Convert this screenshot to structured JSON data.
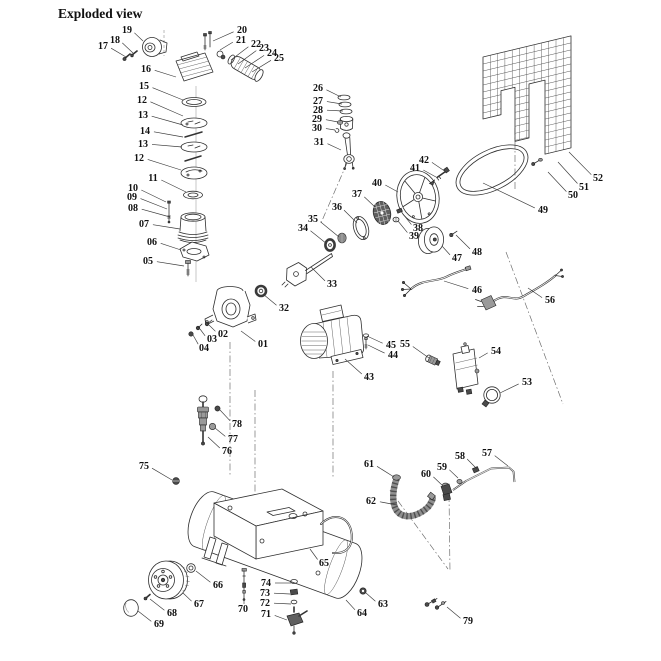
{
  "title": "Exploded view",
  "colors": {
    "ink": "#2f2f2f",
    "background": "#ffffff"
  },
  "diagram": {
    "type": "exploded-parts-diagram",
    "labels": [
      {
        "n": "01",
        "x": 263,
        "y": 344,
        "tx": 241,
        "ty": 331
      },
      {
        "n": "02",
        "x": 223,
        "y": 334,
        "tx": 209,
        "ty": 325
      },
      {
        "n": "03",
        "x": 212,
        "y": 339,
        "tx": 200,
        "ty": 329
      },
      {
        "n": "04",
        "x": 204,
        "y": 348,
        "tx": 193,
        "ty": 335
      },
      {
        "n": "05",
        "x": 148,
        "y": 261,
        "tx": 184,
        "ty": 266
      },
      {
        "n": "06",
        "x": 152,
        "y": 242,
        "tx": 181,
        "ty": 250
      },
      {
        "n": "07",
        "x": 144,
        "y": 224,
        "tx": 180,
        "ty": 229
      },
      {
        "n": "08",
        "x": 133,
        "y": 208,
        "tx": 170,
        "ty": 217
      },
      {
        "n": "09",
        "x": 132,
        "y": 197,
        "tx": 167,
        "ty": 209
      },
      {
        "n": "10",
        "x": 133,
        "y": 188,
        "tx": 166,
        "ty": 202
      },
      {
        "n": "11",
        "x": 153,
        "y": 178,
        "tx": 186,
        "ty": 192
      },
      {
        "n": "12",
        "x": 142,
        "y": 100,
        "tx": 183,
        "ty": 116
      },
      {
        "n": "13",
        "x": 143,
        "y": 115,
        "tx": 183,
        "ty": 125
      },
      {
        "n": "14",
        "x": 145,
        "y": 131,
        "tx": 183,
        "ty": 137
      },
      {
        "n": "13",
        "x": 143,
        "y": 144,
        "tx": 182,
        "ty": 147
      },
      {
        "n": "12",
        "x": 139,
        "y": 158,
        "tx": 181,
        "ty": 170
      },
      {
        "n": "15",
        "x": 144,
        "y": 86,
        "tx": 183,
        "ty": 100
      },
      {
        "n": "16",
        "x": 146,
        "y": 69,
        "tx": 176,
        "ty": 77
      },
      {
        "n": "17",
        "x": 103,
        "y": 46,
        "tx": 126,
        "ty": 57
      },
      {
        "n": "18",
        "x": 115,
        "y": 40,
        "tx": 133,
        "ty": 53
      },
      {
        "n": "19",
        "x": 127,
        "y": 30,
        "tx": 143,
        "ty": 41
      },
      {
        "n": "20",
        "x": 242,
        "y": 30,
        "tx": 213,
        "ty": 41
      },
      {
        "n": "21",
        "x": 241,
        "y": 40,
        "tx": 220,
        "ty": 50
      },
      {
        "n": "22",
        "x": 256,
        "y": 44,
        "tx": 231,
        "ty": 60
      },
      {
        "n": "23",
        "x": 264,
        "y": 48,
        "tx": 238,
        "ty": 64
      },
      {
        "n": "24",
        "x": 272,
        "y": 53,
        "tx": 245,
        "ty": 68
      },
      {
        "n": "25",
        "x": 279,
        "y": 58,
        "tx": 252,
        "ty": 72
      },
      {
        "n": "26",
        "x": 318,
        "y": 88,
        "tx": 341,
        "ty": 97
      },
      {
        "n": "27",
        "x": 318,
        "y": 101,
        "tx": 342,
        "ty": 104
      },
      {
        "n": "28",
        "x": 318,
        "y": 110,
        "tx": 343,
        "ty": 111
      },
      {
        "n": "29",
        "x": 317,
        "y": 119,
        "tx": 338,
        "ty": 122
      },
      {
        "n": "30",
        "x": 317,
        "y": 128,
        "tx": 335,
        "ty": 130
      },
      {
        "n": "31",
        "x": 319,
        "y": 142,
        "tx": 341,
        "ty": 150
      },
      {
        "n": "32",
        "x": 284,
        "y": 308,
        "tx": 263,
        "ty": 294
      },
      {
        "n": "33",
        "x": 332,
        "y": 284,
        "tx": 311,
        "ty": 267
      },
      {
        "n": "34",
        "x": 303,
        "y": 228,
        "tx": 327,
        "ty": 244
      },
      {
        "n": "35",
        "x": 313,
        "y": 219,
        "tx": 339,
        "ty": 237
      },
      {
        "n": "36",
        "x": 337,
        "y": 207,
        "tx": 357,
        "ty": 223
      },
      {
        "n": "37",
        "x": 357,
        "y": 194,
        "tx": 375,
        "ty": 207
      },
      {
        "n": "38",
        "x": 418,
        "y": 228,
        "tx": 403,
        "ty": 214
      },
      {
        "n": "39",
        "x": 414,
        "y": 236,
        "tx": 398,
        "ty": 221
      },
      {
        "n": "40",
        "x": 377,
        "y": 183,
        "tx": 398,
        "ty": 192
      },
      {
        "n": "41",
        "x": 415,
        "y": 168,
        "tx": 436,
        "ty": 177
      },
      {
        "n": "42",
        "x": 424,
        "y": 160,
        "tx": 446,
        "ty": 172
      },
      {
        "n": "43",
        "x": 369,
        "y": 377,
        "tx": 345,
        "ty": 359
      },
      {
        "n": "44",
        "x": 393,
        "y": 355,
        "tx": 368,
        "ty": 345
      },
      {
        "n": "45",
        "x": 391,
        "y": 345,
        "tx": 367,
        "ty": 336
      },
      {
        "n": "46",
        "x": 477,
        "y": 290,
        "tx": 444,
        "ty": 281
      },
      {
        "n": "47",
        "x": 457,
        "y": 258,
        "tx": 442,
        "ty": 246
      },
      {
        "n": "48",
        "x": 477,
        "y": 252,
        "tx": 456,
        "ty": 235
      },
      {
        "n": "49",
        "x": 543,
        "y": 210,
        "tx": 483,
        "ty": 183
      },
      {
        "n": "50",
        "x": 573,
        "y": 195,
        "tx": 548,
        "ty": 172
      },
      {
        "n": "51",
        "x": 584,
        "y": 187,
        "tx": 558,
        "ty": 162
      },
      {
        "n": "52",
        "x": 598,
        "y": 178,
        "tx": 569,
        "ty": 152
      },
      {
        "n": "53",
        "x": 527,
        "y": 382,
        "tx": 500,
        "ty": 393
      },
      {
        "n": "54",
        "x": 496,
        "y": 351,
        "tx": 479,
        "ty": 358
      },
      {
        "n": "55",
        "x": 405,
        "y": 344,
        "tx": 429,
        "ty": 358
      },
      {
        "n": "56",
        "x": 550,
        "y": 300,
        "tx": 528,
        "ty": 288
      },
      {
        "n": "57",
        "x": 487,
        "y": 453,
        "tx": 508,
        "ty": 466
      },
      {
        "n": "58",
        "x": 460,
        "y": 456,
        "tx": 477,
        "ty": 469
      },
      {
        "n": "59",
        "x": 442,
        "y": 467,
        "tx": 458,
        "ty": 478
      },
      {
        "n": "60",
        "x": 426,
        "y": 474,
        "tx": 443,
        "ty": 486
      },
      {
        "n": "61",
        "x": 369,
        "y": 464,
        "tx": 394,
        "ty": 477
      },
      {
        "n": "62",
        "x": 371,
        "y": 501,
        "tx": 397,
        "ty": 505
      },
      {
        "n": "63",
        "x": 383,
        "y": 604,
        "tx": 366,
        "ty": 593
      },
      {
        "n": "64",
        "x": 362,
        "y": 613,
        "tx": 346,
        "ty": 600
      },
      {
        "n": "65",
        "x": 324,
        "y": 563,
        "tx": 310,
        "ty": 549
      },
      {
        "n": "66",
        "x": 218,
        "y": 585,
        "tx": 196,
        "ty": 571
      },
      {
        "n": "67",
        "x": 199,
        "y": 604,
        "tx": 183,
        "ty": 593
      },
      {
        "n": "68",
        "x": 172,
        "y": 613,
        "tx": 150,
        "ty": 599
      },
      {
        "n": "69",
        "x": 159,
        "y": 624,
        "tx": 138,
        "ty": 611
      },
      {
        "n": "70",
        "x": 243,
        "y": 609,
        "tx": 244,
        "ty": 600
      },
      {
        "n": "71",
        "x": 266,
        "y": 614,
        "tx": 287,
        "ty": 620
      },
      {
        "n": "72",
        "x": 265,
        "y": 603,
        "tx": 291,
        "ty": 604
      },
      {
        "n": "73",
        "x": 265,
        "y": 593,
        "tx": 290,
        "ty": 594
      },
      {
        "n": "74",
        "x": 266,
        "y": 583,
        "tx": 291,
        "ty": 583
      },
      {
        "n": "75",
        "x": 144,
        "y": 466,
        "tx": 172,
        "ty": 480
      },
      {
        "n": "76",
        "x": 227,
        "y": 451,
        "tx": 208,
        "ty": 437
      },
      {
        "n": "77",
        "x": 233,
        "y": 439,
        "tx": 215,
        "ty": 428
      },
      {
        "n": "78",
        "x": 237,
        "y": 424,
        "tx": 220,
        "ty": 410
      },
      {
        "n": "79",
        "x": 468,
        "y": 621,
        "tx": 447,
        "ty": 607
      }
    ]
  }
}
